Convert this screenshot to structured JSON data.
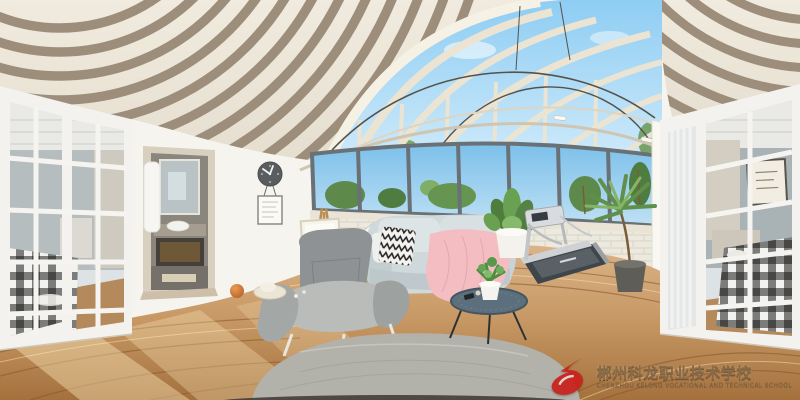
{
  "image": {
    "type": "360-degree equirectangular panorama",
    "subject": "sunroom living room interior rendering",
    "alt": "Panoramic sunroom with slatted beam ceiling, glass skylight, mobile chandelier, casement windows over a white brick half wall, gray sofa with pink blanket and pillows, armchair with ottoman, easel, telescope, round coffee table with plant, treadmill, potted plants, curved wood plank floor, bathroom doorway and wall clock on the left, and a bedroom with a buffalo-plaid bed seen through white french doors on both edges"
  },
  "watermark": {
    "title": "郴州科龙职业技术学校",
    "subtitle": "CHENZHOU KELONG VOCATIONAL AND TECHNICAL SCHOOL",
    "title_color": "#8a6b49",
    "subtitle_color": "#7d6342",
    "logo_color": "#c9201b"
  },
  "clock": {
    "approx_time": "10:10"
  },
  "palette": {
    "wall_white": "#f6f4ee",
    "ceiling_cream": "#ece6d8",
    "ceiling_beam": "#9d8e7b",
    "sky": "#8ecdf3",
    "window_frame": "#6a7176",
    "brick_wall": "#eceadf",
    "floor_wood": "#c79a68",
    "sofa_body": "#cfd8da",
    "blanket_pink": "#f3bdc2",
    "pillow_yellow": "#ece9a6",
    "armchair_gray": "#8e9294",
    "ottoman_gray": "#b2b1aa",
    "table_top": "#5c6f7d",
    "plant_green": "#5f9049",
    "treadmill_gray": "#ced2d4",
    "door_frame_white": "#f3f2ee",
    "plaid_dark": "#1c1c1c"
  },
  "objects": [
    "striped slat ceiling",
    "glass skylight",
    "mobile chandelier",
    "casement windows",
    "white brick half wall",
    "french doors to bedroom",
    "buffalo plaid bed",
    "bathroom doorway",
    "vanity with vessel sink",
    "white towel",
    "wall clock",
    "memo frame",
    "easel with sketch",
    "telescope",
    "two-seat sofa",
    "zigzag pillow",
    "yellow pillow",
    "pink throw blanket",
    "lounge armchair",
    "fabric ottoman",
    "round coffee table",
    "potted plants",
    "treadmill",
    "curved wood plank floor",
    "orange ball",
    "sun hat",
    "nadir shadow"
  ]
}
